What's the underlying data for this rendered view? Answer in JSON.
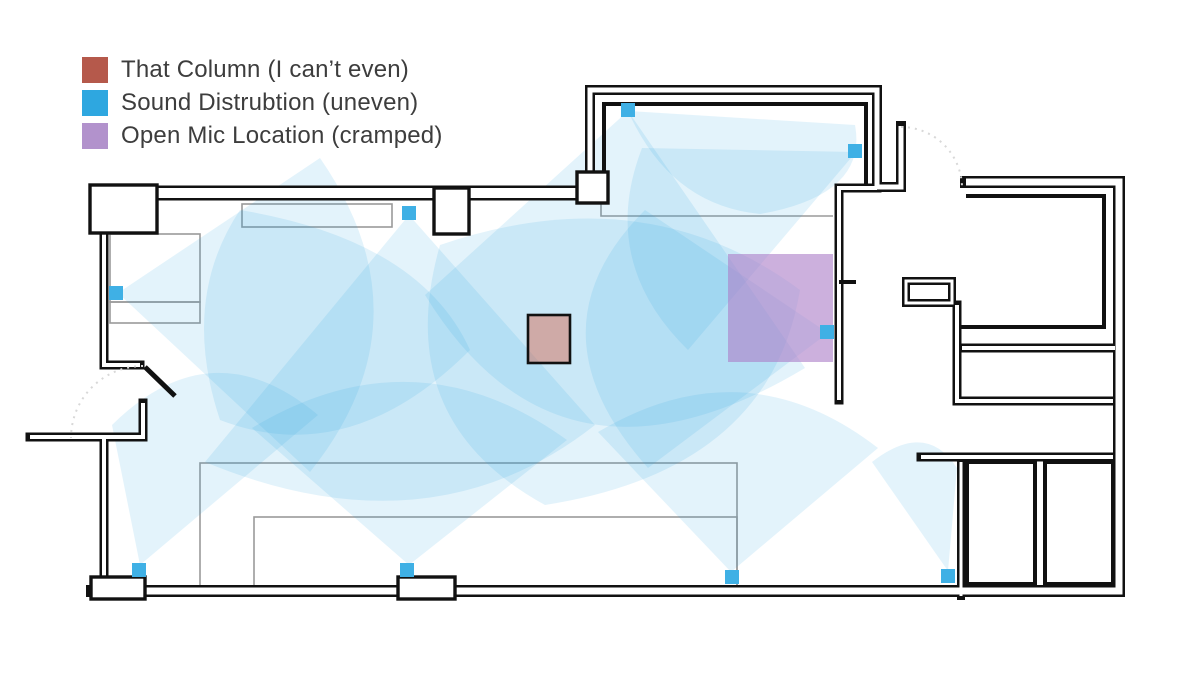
{
  "legend": {
    "items": [
      {
        "label": "That Column (I can’t even)",
        "color": "#B5594B"
      },
      {
        "label": "Sound Distrubtion (uneven)",
        "color": "#2EA7E0"
      },
      {
        "label": "Open Mic Location (cramped)",
        "color": "#B292CC"
      }
    ]
  },
  "floor_plan": {
    "column": {
      "x": 528,
      "y": 315,
      "w": 42,
      "h": 48,
      "color": "#D45F45",
      "opacity": 0.45,
      "stroke": "#111111"
    },
    "open_mic": {
      "x": 728,
      "y": 254,
      "w": 105,
      "h": 108,
      "color": "#AD7FC8",
      "opacity": 0.62
    },
    "speakers": {
      "color": "#3FB0E5",
      "size": 14,
      "positions": [
        [
          109,
          286
        ],
        [
          402,
          206
        ],
        [
          621,
          103
        ],
        [
          848,
          144
        ],
        [
          820,
          325
        ],
        [
          132,
          563
        ],
        [
          400,
          563
        ],
        [
          725,
          570
        ],
        [
          941,
          569
        ]
      ]
    },
    "coverage": {
      "color": "#29A3DF",
      "opacity": 0.13,
      "areas": [
        "M118,293 L320,158 Q432,320 310,472 Z",
        "M409,215 L205,462 Q430,555 595,425 Z",
        "M628,111 L425,295 Q560,515 805,368 Z",
        "M628,111 L855,125 Q868,195 760,214 Q670,205 628,111 Z",
        "M856,152 L642,148 Q598,262 688,350 Z",
        "M828,333 L645,210 Q525,330 648,468 Z",
        "M140,565 L318,415 Q212,326 112,425 Z",
        "M409,565 L252,428 Q415,330 567,440 Z",
        "M731,572 L598,432 Q745,345 878,448 Z",
        "M948,571 L872,462 Q926,420 957,468 Z",
        "M440,245 Q645,175 800,290 Q770,470 545,505 Q390,420 440,245 Z",
        "M240,210 Q420,240 470,350 Q350,470 220,420 Q180,300 240,210 Z"
      ]
    }
  }
}
